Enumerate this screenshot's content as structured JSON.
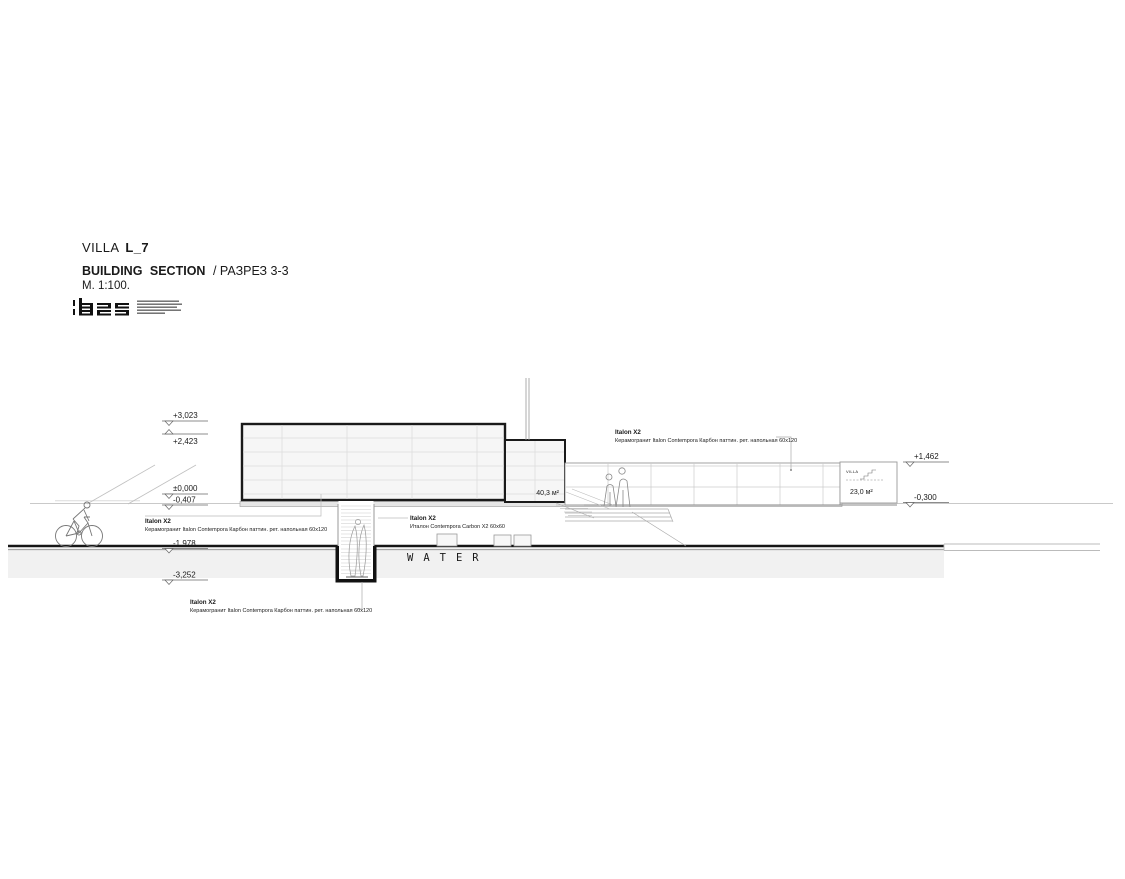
{
  "title_block": {
    "project_name": "VILLA",
    "project_code": "L_7",
    "drawing_title_en": "BUILDING SECTION",
    "drawing_title_ru": "/ РАЗРЕЗ 3-3",
    "scale": "M. 1:100.",
    "logo_text": "b25"
  },
  "levels": {
    "roof": "+3,023",
    "parapet": "+2,423",
    "zero": "±0,000",
    "terrace": "-0,407",
    "lower_ground": "-1,978",
    "basement": "-3,252",
    "right_roof": "+1,462",
    "right_ground": "-0,300"
  },
  "annotations": {
    "left": {
      "title": "Italon X2",
      "text": "Керамогранит Italon Contempora Карбон паттин. рет. напольная 60x120"
    },
    "middle": {
      "title": "Italon X2",
      "text": "Италон Contempora Carbon X2 60x60"
    },
    "top_right": {
      "title": "Italon X2",
      "text": "Керамогранит Italon Contempora Карбон паттин. рет. напольная 60х120"
    },
    "bottom": {
      "title": "Italon X2",
      "text": "Керамогранит Italon Contempora Карбон паттин. рет. напольная 60x120"
    }
  },
  "labels": {
    "area_main": "40,3 м²",
    "area_right": "23,0 м²",
    "water": "WATER",
    "villa_small": "VILLA"
  }
}
